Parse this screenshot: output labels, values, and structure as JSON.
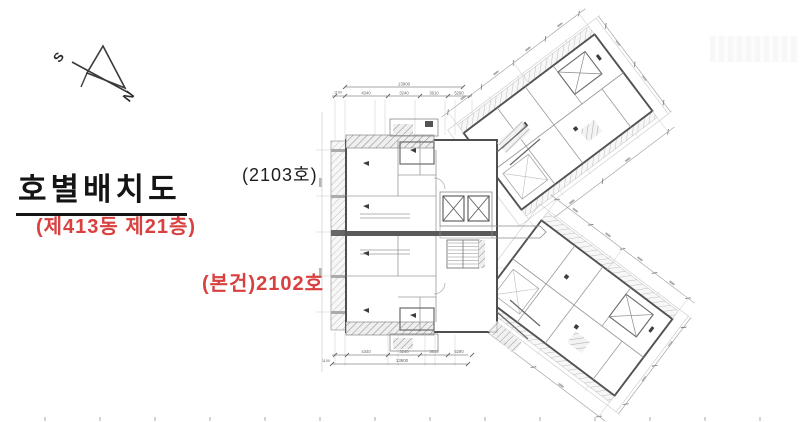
{
  "window": {
    "width": 800,
    "height": 422,
    "background": "#ffffff"
  },
  "compass": {
    "south_label": "S",
    "north_label": "N"
  },
  "title": {
    "text": "호별배치도"
  },
  "subtitle": {
    "text": "(제413동 제21층)"
  },
  "labels": {
    "unit_2103": {
      "text": "(2103호)"
    },
    "unit_2102": {
      "text": "(본건)2102호"
    }
  },
  "floor_plan": {
    "dimensions_top": {
      "left_offset": "1100",
      "total": "13900",
      "segments": [
        "4340",
        "3240",
        "3610",
        "5290"
      ]
    },
    "dimensions_bottom": {
      "left_offset": "1100",
      "total": "13900",
      "segments": [
        "4340",
        "3240",
        "3610",
        "5290"
      ]
    }
  },
  "colors": {
    "accent_red": "#d94040",
    "text_black": "#141414",
    "wall_dark": "#4f4f4f",
    "line_medium": "#8a8a8a",
    "line_light": "#c8c8c8"
  }
}
